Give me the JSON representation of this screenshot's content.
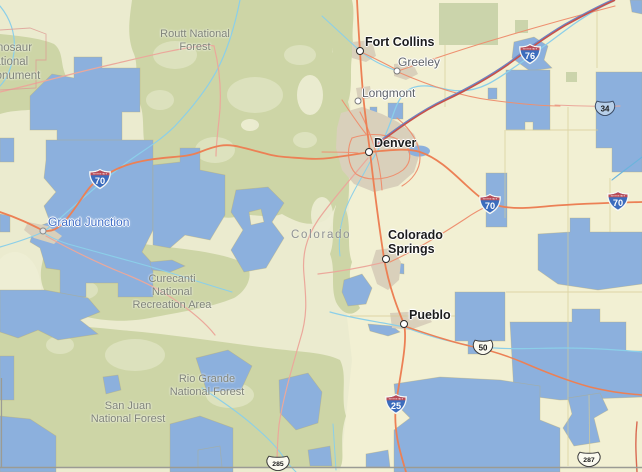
{
  "state_label": "Colorado",
  "cities": [
    {
      "name": "Fort Collins",
      "type": "major"
    },
    {
      "name": "Greeley",
      "type": "minor"
    },
    {
      "name": "Longmont",
      "type": "minor"
    },
    {
      "name": "Denver",
      "type": "major"
    },
    {
      "name": "Grand Junction",
      "type": "town"
    },
    {
      "name": "Colorado\nSprings",
      "type": "major"
    },
    {
      "name": "Pueblo",
      "type": "major"
    }
  ],
  "areas": [
    {
      "name": "Dinosaur\nNational\nMonument"
    },
    {
      "name": "Routt National\nForest"
    },
    {
      "name": "Curecanti\nNational\nRecreation Area"
    },
    {
      "name": "Rio Grande\nNational Forest"
    },
    {
      "name": "San Juan\nNational Forest"
    }
  ],
  "shields": {
    "caption": "INTERSTATE",
    "interstate": [
      {
        "num": "70"
      },
      {
        "num": "70"
      },
      {
        "num": "70"
      },
      {
        "num": "76"
      },
      {
        "num": "25"
      }
    ],
    "us_routes": [
      {
        "num": "34",
        "fill": "#b7cfe9"
      },
      {
        "num": "50",
        "fill": "#fbfaf0"
      },
      {
        "num": "285",
        "fill": "#fbfaf0"
      },
      {
        "num": "287",
        "fill": "#fbfaf0"
      }
    ]
  },
  "colors": {
    "plains": "#f2f0d3",
    "forest_green": "#cdd5a6",
    "federal_land_blue": "#8cb0dd",
    "urban_tan": "#d9d0bb",
    "road_major": "#ec8055",
    "road_minor": "#eba89b",
    "river": "#8bcfe9",
    "interstate_shield_blue": "#3c6cbd",
    "interstate_shield_red": "#b94a55",
    "county_line": "#d6cc96",
    "state_border": "#9b9b94",
    "city_label": "#1c1c1c",
    "minor_city_label": "#5f6369",
    "grand_junction_label_blue": "#3f6dc6",
    "area_label": "#80847a"
  }
}
